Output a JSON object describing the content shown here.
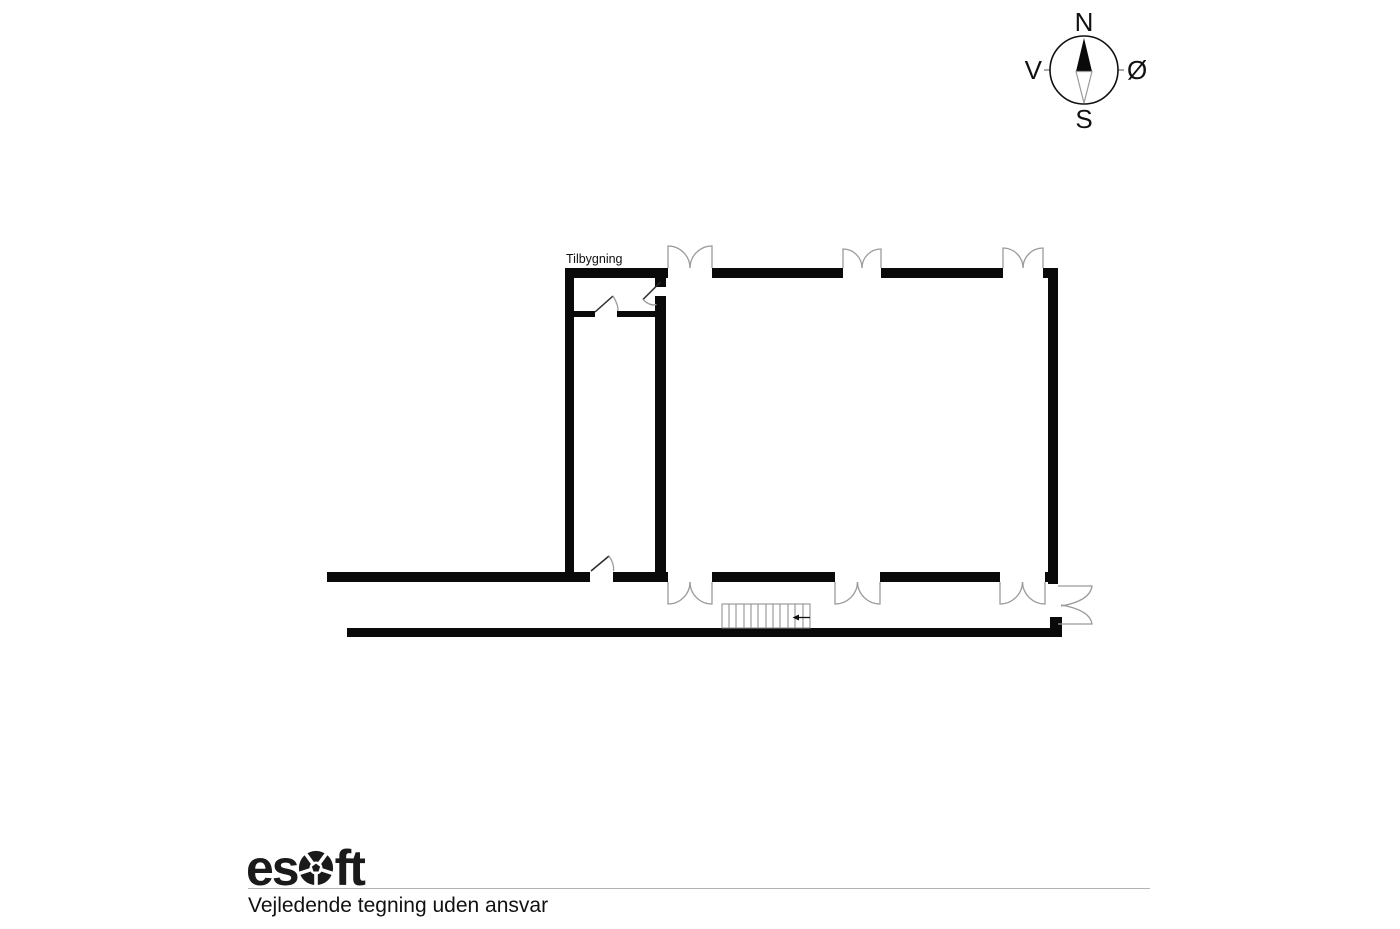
{
  "plan": {
    "extension_label": "Tilbygning"
  },
  "compass": {
    "north": "N",
    "south": "S",
    "west": "V",
    "east": "Ø"
  },
  "footer": {
    "brand_prefix": "es",
    "brand_suffix": "ft",
    "disclaimer": "Vejledende tegning uden ansvar"
  },
  "colors": {
    "wall": "#0a0a0a",
    "door_arc": "#9b9b9b",
    "stair_line": "#8a8a8a",
    "text": "#111111",
    "rule": "#b3b3b3",
    "background": "#ffffff"
  }
}
